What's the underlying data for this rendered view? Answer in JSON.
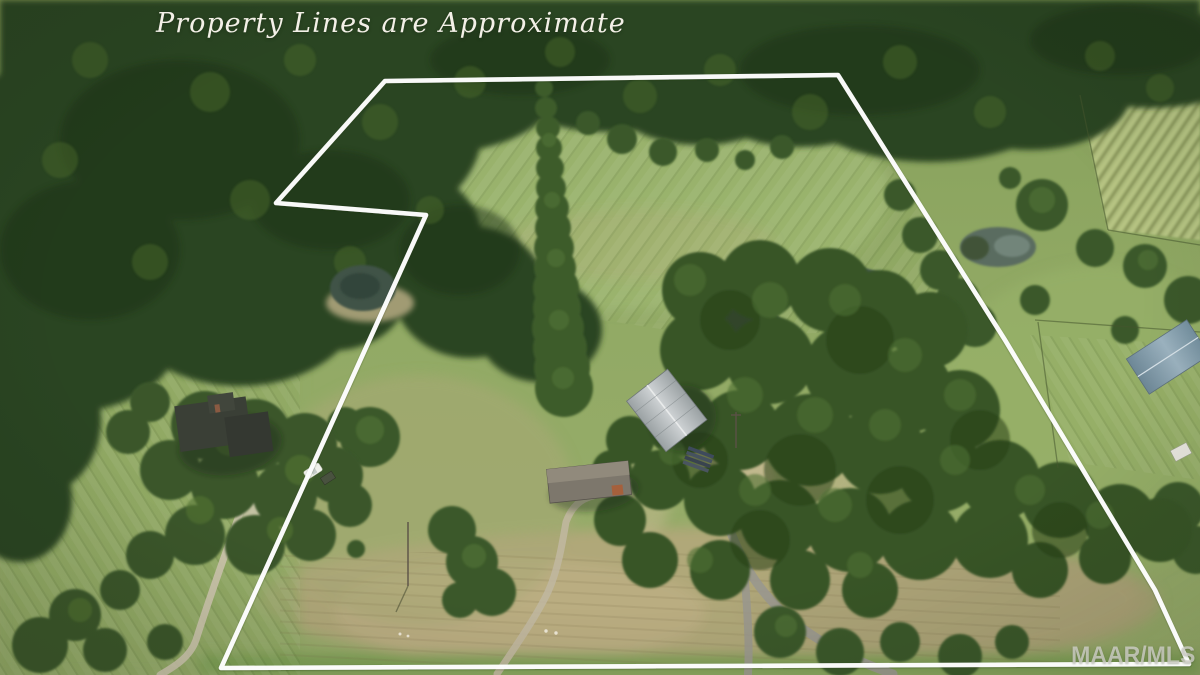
{
  "image": {
    "type": "aerial-drone-photo",
    "description": "Aerial photo of rural acreage: forest band at top, green pastures, tree rows, ponds, houses and a road, with a white approximate property-boundary overlay",
    "disclaimer_text": "Property Lines are Approximate",
    "watermark_text": "MAAR/MLS"
  },
  "boundary": {
    "color": "#ffffff",
    "stroke_width": 4.6,
    "points": "385,81 838,75 1005,340 1155,590 1189,664 221,668 426,215 276,203 385,81"
  },
  "palette": {
    "forest_dark": "#2b431f",
    "pasture_green": "#8fa862",
    "dry_grass": "#b3a87c",
    "pond_water": "#3f5347",
    "road_gray": "#9a988d",
    "metal_roof": "#bcc1c3",
    "blue_roof": "#7e96a6",
    "dark_roof": "#383c33",
    "watermark_gray": "#d2d2cc",
    "line_white": "#ffffff"
  }
}
